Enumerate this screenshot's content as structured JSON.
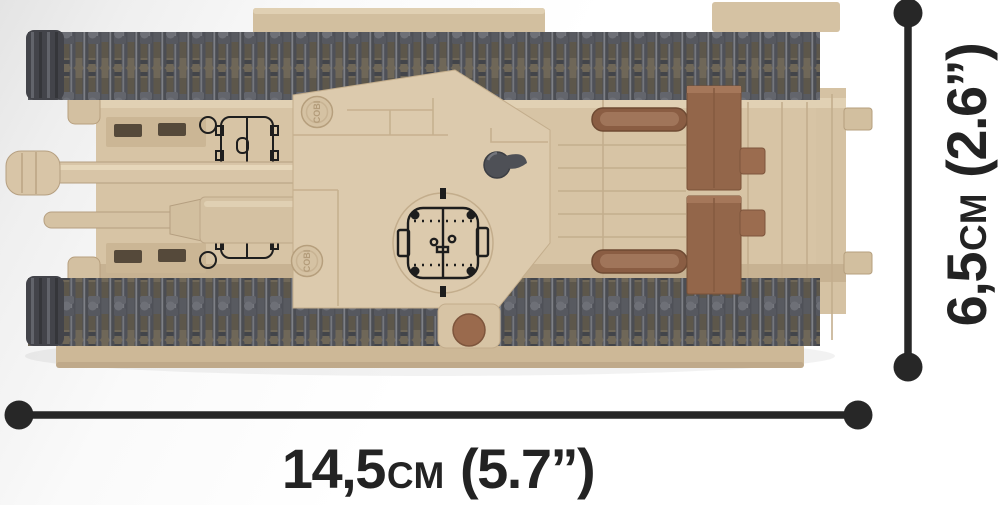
{
  "dimension_labels": {
    "width": {
      "metric_value": "14,5",
      "metric_unit": "cm",
      "imperial": "(5.7”)"
    },
    "height": {
      "metric_value": "6,5",
      "metric_unit": "cm",
      "imperial": "(2.6”)"
    }
  },
  "brand": {
    "stud_text": "COBI"
  },
  "colors": {
    "dimension_marks": "#272727",
    "hull_tan": "#d7c4a5",
    "hull_tan_light": "#e2d2b5",
    "hull_tan_shadow": "#c7b292",
    "track_gray": "#53545a",
    "track_base": "#6f6758",
    "stowage_brown": "#96674b",
    "exhaust_brown": "#8a5d43",
    "print_black": "#1d1d1d",
    "background_corner": "#e4e4e4"
  }
}
